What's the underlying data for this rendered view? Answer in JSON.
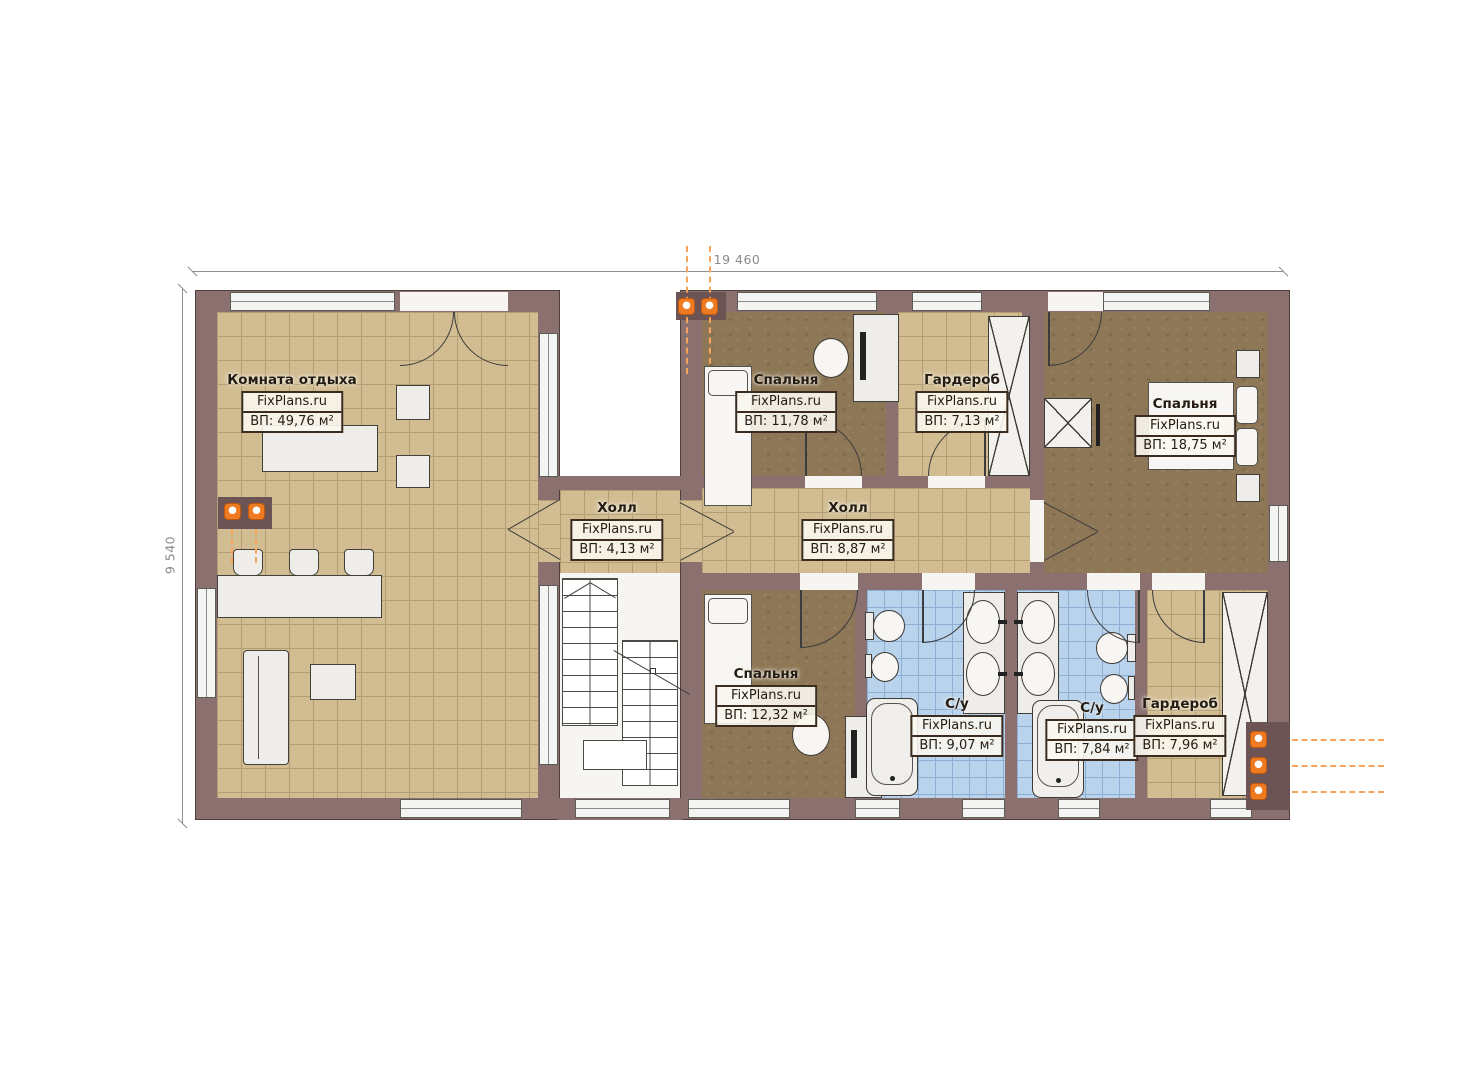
{
  "title": "Floor plan (second level) with room areas",
  "dimensions": {
    "top": "19 460",
    "left": "9 540"
  },
  "rooms": {
    "lounge": {
      "name": "Комната отдыха",
      "brand": "FixPlans.ru",
      "area": "ВП: 49,76 м²"
    },
    "bedroom1": {
      "name": "Спальня",
      "brand": "FixPlans.ru",
      "area": "ВП: 11,78 м²"
    },
    "wardrobe1": {
      "name": "Гардероб",
      "brand": "FixPlans.ru",
      "area": "ВП: 7,13 м²"
    },
    "bedroom2": {
      "name": "Спальня",
      "brand": "FixPlans.ru",
      "area": "ВП: 18,75 м²"
    },
    "hall1": {
      "name": "Холл",
      "brand": "FixPlans.ru",
      "area": "ВП: 4,13 м²"
    },
    "hall2": {
      "name": "Холл",
      "brand": "FixPlans.ru",
      "area": "ВП: 8,87 м²"
    },
    "bedroom3": {
      "name": "Спальня",
      "brand": "FixPlans.ru",
      "area": "ВП: 12,32 м²"
    },
    "bath1": {
      "name": "С/у",
      "brand": "FixPlans.ru",
      "area": "ВП: 9,07 м²"
    },
    "bath2": {
      "name": "С/у",
      "brand": "FixPlans.ru",
      "area": "ВП: 7,84 м²"
    },
    "wardrobe2": {
      "name": "Гардероб",
      "brand": "FixPlans.ru",
      "area": "ВП: 7,96 м²"
    }
  },
  "colors": {
    "wall": "#8b7070",
    "floor_tile": "#d2bd92",
    "floor_carpet": "#8d7756",
    "floor_bath": "#b9d3ec",
    "accent_lamp": "#ee7a22",
    "dimension": "#8f8f8f"
  }
}
